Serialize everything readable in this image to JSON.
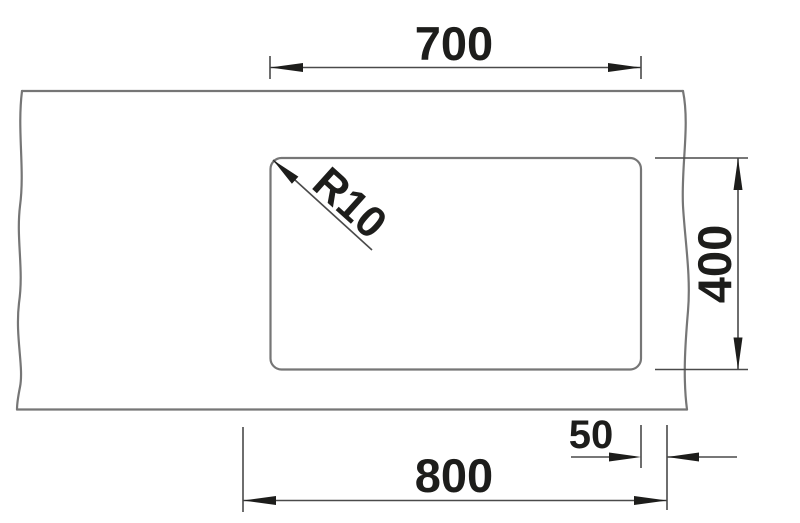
{
  "drawing": {
    "kind": "technical dimension drawing of a rectangular worktop cutout",
    "labels": {
      "cutout_width": "700",
      "cutout_depth": "400",
      "overall_width": "800",
      "side_offset": "50",
      "corner_radius": "R10"
    },
    "colors": {
      "background": "#ffffff",
      "object_line": "#767676",
      "dimension_line": "#4a4a4a",
      "ink": "#1d1d1b"
    }
  }
}
